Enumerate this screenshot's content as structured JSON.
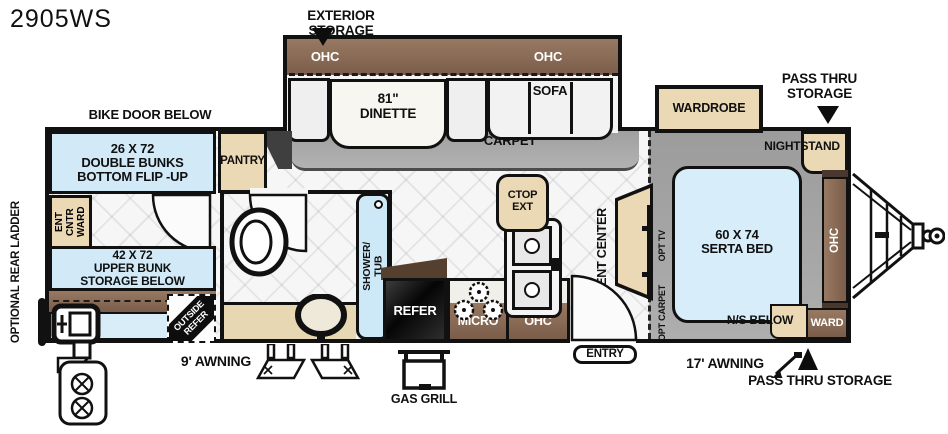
{
  "title": "2905WS",
  "palette": {
    "cabinet_brown": "#8a6c59",
    "accent_tan": "#ead9b4",
    "fixture_blue": "#d2eaf8",
    "carpet_gray": "#a6a6a6",
    "wall_black": "#111111"
  },
  "top": {
    "exterior_storage": "EXTERIOR  STORAGE",
    "bike_door_below": "BIKE DOOR BELOW",
    "pass_thru_storage": "PASS THRU\nSTORAGE"
  },
  "slide": {
    "ohc_left": "OHC",
    "ohc_right": "OHC",
    "dinette": "81\"\nDINETTE",
    "sofa": "SOFA",
    "carpet": "CARPET"
  },
  "bunkhouse": {
    "double_bunks": "26 X 72\nDOUBLE BUNKS\nBOTTOM FLIP -UP",
    "ent_cntr_ward": "ENT CNTR\nWARD",
    "upper_bunk": "42 X 72\nUPPER BUNK\nSTORAGE BELOW",
    "outside_refer": "OUTSIDE\nREFER",
    "optional_rear_ladder": "OPTIONAL  REAR LADDER",
    "pantry": "PANTRY"
  },
  "bathroom": {
    "shower_tub": "SHOWER/\nTUB"
  },
  "kitchen": {
    "refer": "REFER",
    "micro": "MICRO",
    "ohc": "OHC",
    "ctop_ext": "CTOP\nEXT"
  },
  "living": {
    "ent_center": "ENT CENTER",
    "opt_tv": "OPT TV"
  },
  "bedroom": {
    "wardrobe": "WARDROBE",
    "nightstand": "NIGHTSTAND",
    "bed": "60 X 74\nSERTA BED",
    "ohc": "OHC",
    "ns_below": "N/S BELOW",
    "ward": "WARD",
    "opt_carpet": "OPT CARPET"
  },
  "exterior": {
    "awning_rear": "9' AWNING",
    "awning_front": "17' AWNING",
    "gas_grill": "GAS GRILL",
    "entry": "ENTRY",
    "pass_thru_storage": "PASS THRU  STORAGE"
  }
}
